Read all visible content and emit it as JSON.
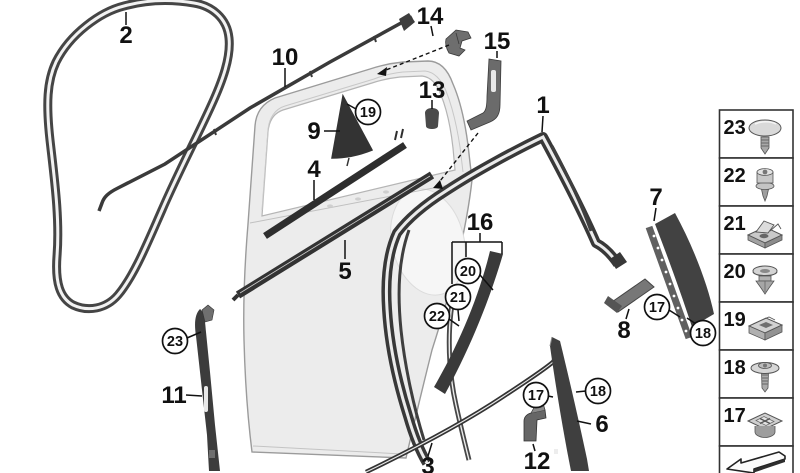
{
  "diagram": {
    "colors": {
      "background": "#ffffff",
      "line": "#111111",
      "seal_dark": "#3a3a3a",
      "seal_mid": "#4a4a4a",
      "body_fill": "#ececec",
      "body_stroke": "#9b9b9b",
      "window_fill": "#ffffff"
    },
    "callouts": [
      {
        "id": "2",
        "text": "2",
        "shape": "plain",
        "x": 126,
        "y": 35
      },
      {
        "id": "10",
        "text": "10",
        "shape": "plain",
        "x": 285,
        "y": 57
      },
      {
        "id": "14",
        "text": "14",
        "shape": "plain",
        "x": 430,
        "y": 16
      },
      {
        "id": "15",
        "text": "15",
        "shape": "plain",
        "x": 497,
        "y": 41
      },
      {
        "id": "13",
        "text": "13",
        "shape": "plain",
        "x": 432,
        "y": 90
      },
      {
        "id": "9",
        "text": "9",
        "shape": "plain",
        "x": 314,
        "y": 131
      },
      {
        "id": "19",
        "text": "19",
        "shape": "circled",
        "x": 368,
        "y": 112
      },
      {
        "id": "4",
        "text": "4",
        "shape": "plain",
        "x": 314,
        "y": 169
      },
      {
        "id": "1",
        "text": "1",
        "shape": "plain",
        "x": 543,
        "y": 105
      },
      {
        "id": "5",
        "text": "5",
        "shape": "plain",
        "x": 345,
        "y": 271
      },
      {
        "id": "16",
        "text": "16",
        "shape": "plain",
        "x": 480,
        "y": 222
      },
      {
        "id": "20",
        "text": "20",
        "shape": "circled",
        "x": 468,
        "y": 271
      },
      {
        "id": "21",
        "text": "21",
        "shape": "circled",
        "x": 458,
        "y": 297
      },
      {
        "id": "22",
        "text": "22",
        "shape": "circled",
        "x": 437,
        "y": 316
      },
      {
        "id": "7",
        "text": "7",
        "shape": "plain",
        "x": 656,
        "y": 197
      },
      {
        "id": "8",
        "text": "8",
        "shape": "plain",
        "x": 624,
        "y": 330
      },
      {
        "id": "17a",
        "text": "17",
        "shape": "circled",
        "x": 657,
        "y": 307
      },
      {
        "id": "18a",
        "text": "18",
        "shape": "circled",
        "x": 703,
        "y": 333
      },
      {
        "id": "23",
        "text": "23",
        "shape": "circled",
        "x": 175,
        "y": 341
      },
      {
        "id": "11",
        "text": "11",
        "shape": "plain",
        "x": 174,
        "y": 395
      },
      {
        "id": "17b",
        "text": "17",
        "shape": "circled",
        "x": 536,
        "y": 395
      },
      {
        "id": "18b",
        "text": "18",
        "shape": "circled",
        "x": 598,
        "y": 391
      },
      {
        "id": "6",
        "text": "6",
        "shape": "plain",
        "x": 602,
        "y": 424
      },
      {
        "id": "12",
        "text": "12",
        "shape": "plain",
        "x": 537,
        "y": 461
      },
      {
        "id": "3",
        "text": "3",
        "shape": "plain",
        "x": 428,
        "y": 466
      }
    ],
    "legend": {
      "items": [
        {
          "number": "23",
          "icon": "dome-rivet"
        },
        {
          "number": "22",
          "icon": "torx-screw"
        },
        {
          "number": "21",
          "icon": "cage-nut"
        },
        {
          "number": "20",
          "icon": "expanding-rivet"
        },
        {
          "number": "19",
          "icon": "clip-nut"
        },
        {
          "number": "18",
          "icon": "washer-screw"
        },
        {
          "number": "17",
          "icon": "square-grommet"
        }
      ],
      "footer_icon": "direction-arrow"
    }
  }
}
